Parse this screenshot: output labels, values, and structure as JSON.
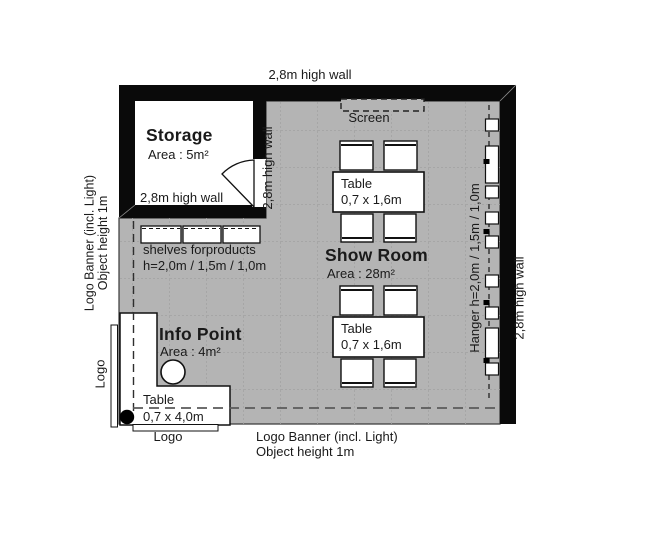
{
  "walls": {
    "top": "2,8m high wall",
    "storage_bottom": "2,8m high wall",
    "storage_side": "2,8m high wall",
    "right": "2,8m high wall"
  },
  "storage": {
    "title": "Storage",
    "area": "Area : 5m²"
  },
  "screen": {
    "label": "Screen"
  },
  "shelves": {
    "line1": "shelves forproducts",
    "line2": "h=2,0m / 1,5m / 1,0m"
  },
  "showroom": {
    "title": "Show Room",
    "area": "Area : 28m²"
  },
  "tables": {
    "showroom": {
      "line1": "Table",
      "line2": "0,7 x 1,6m"
    },
    "info": {
      "line1": "Table",
      "line2": "0,7 x 4,0m"
    }
  },
  "hanger": {
    "label": "Hanger h=2,0m / 1,5m / 1,0m"
  },
  "info_point": {
    "title": "Info Point",
    "area": "Area : 4m²"
  },
  "left_banner": {
    "line1": "Logo Banner (incl. Light)",
    "line2": "Object height 1m",
    "logo": "Logo"
  },
  "bottom_banner": {
    "line1": "Logo Banner (incl. Light)",
    "line2": "Object height 1m",
    "logo": "Logo"
  },
  "colors": {
    "wall": "#0a0a0a",
    "floor": "#b4b4b4",
    "grid": "#a2a2a2",
    "text": "#1a1a1a",
    "white": "#ffffff"
  }
}
